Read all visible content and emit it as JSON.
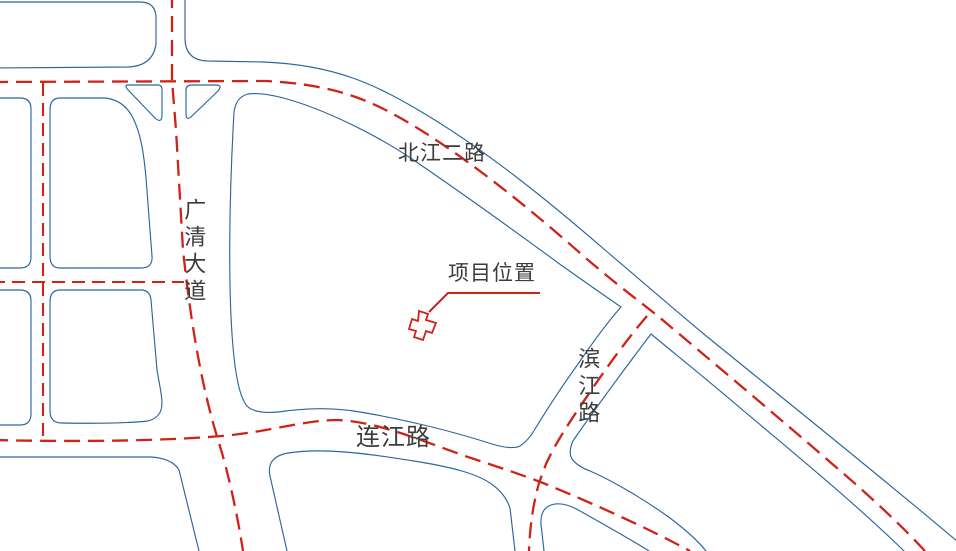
{
  "map": {
    "type": "site-location-road-map",
    "background": "#ffffff",
    "colors": {
      "road_outline_blue": "#2b66a0",
      "centerline_red": "#cf2318",
      "label_text": "#3c3c3c"
    },
    "labels": {
      "north_road": "北江二路",
      "west_avenue": "广清大道",
      "east_road": "滨江路",
      "south_road": "连江路",
      "project_location": "项目位置"
    }
  }
}
